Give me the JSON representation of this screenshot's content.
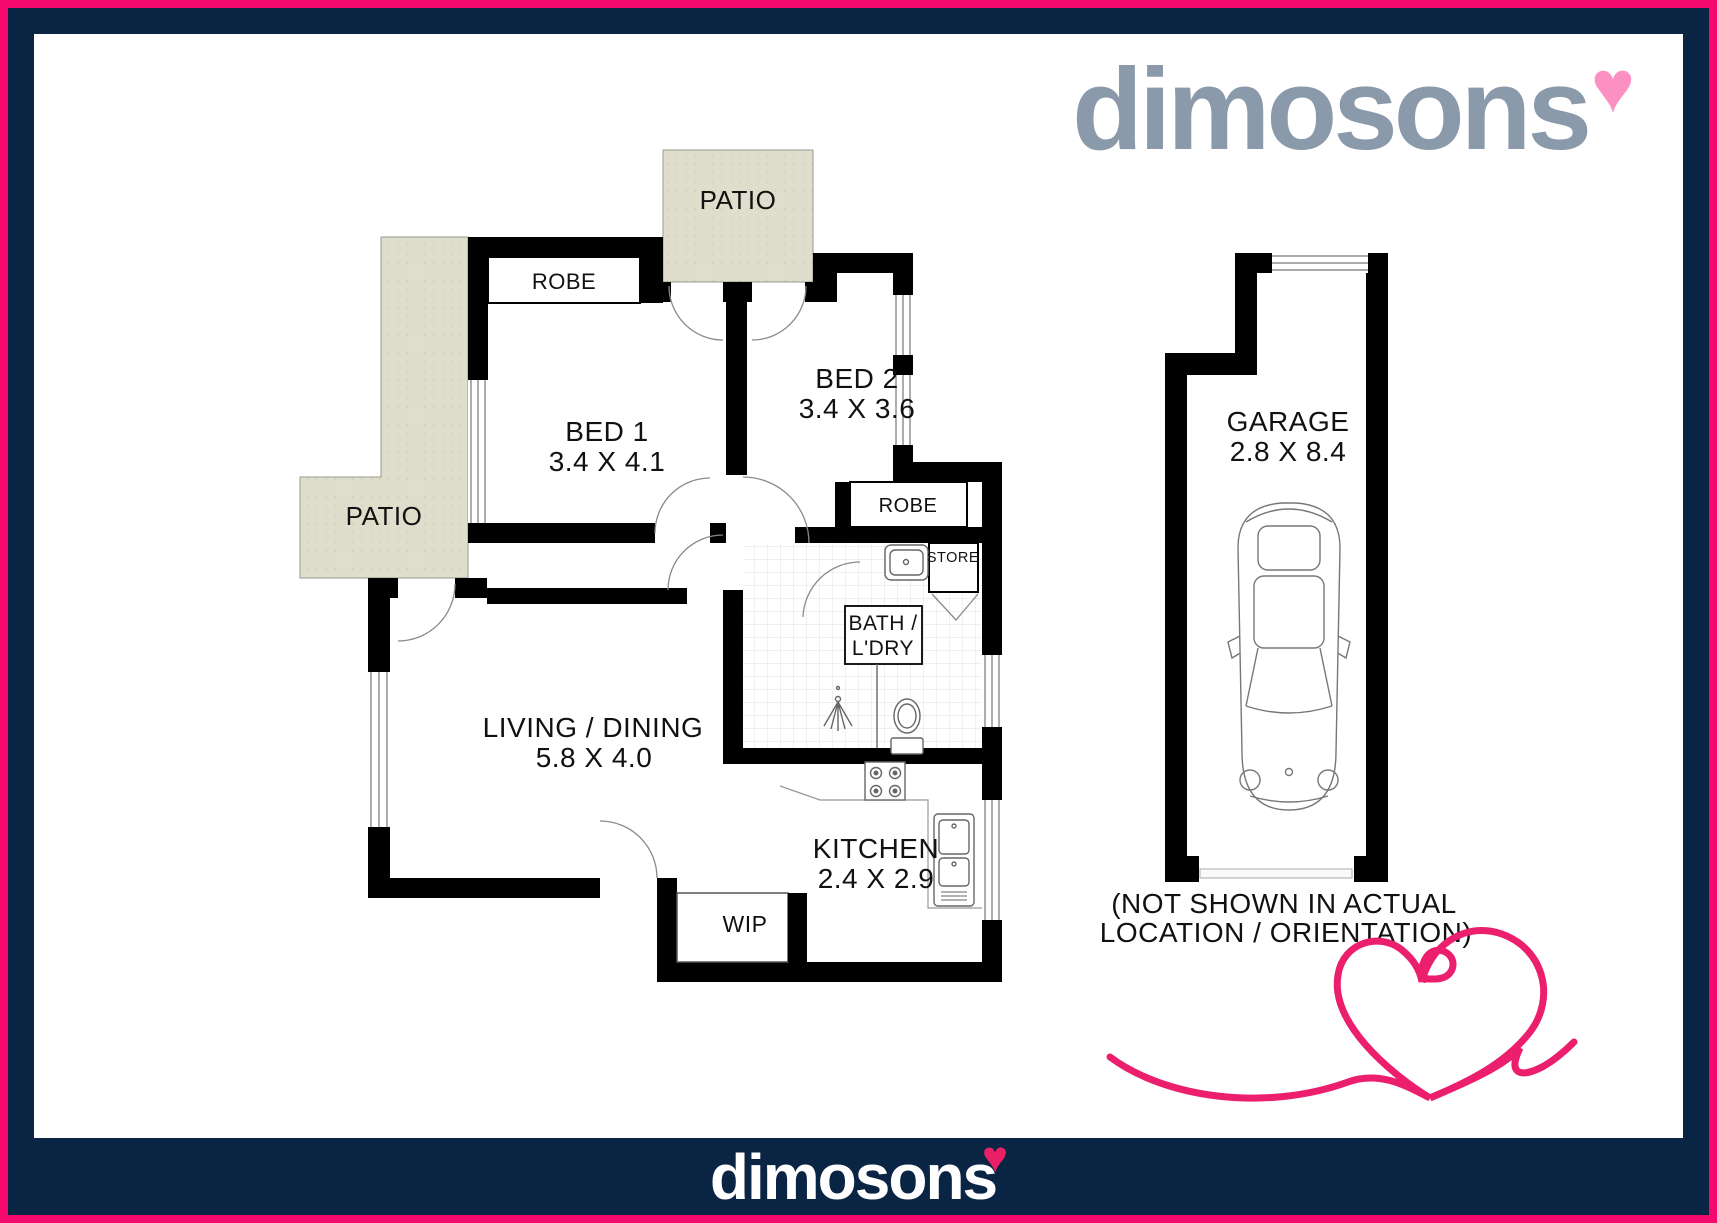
{
  "branding": {
    "logo_text": "dimosons",
    "logo_heart": "♥",
    "logo_color": "#8b9aab",
    "logo_heart_color": "#fc90c2",
    "accent_pink": "#f5096d",
    "navy": "#0a2444",
    "squiggle_pink": "#ec1e6e"
  },
  "floorplan": {
    "rooms": [
      {
        "id": "bed1",
        "name": "BED 1",
        "dims": "3.4 X 4.1"
      },
      {
        "id": "bed2",
        "name": "BED 2",
        "dims": "3.4 X 3.6"
      },
      {
        "id": "living",
        "name": "LIVING / DINING",
        "dims": "5.8 X 4.0"
      },
      {
        "id": "kitchen",
        "name": "KITCHEN",
        "dims": "2.4 X 2.9"
      },
      {
        "id": "garage",
        "name": "GARAGE",
        "dims": "2.8 X 8.4"
      }
    ],
    "labels": {
      "patio_top": "PATIO",
      "patio_left": "PATIO",
      "robe_bed1": "ROBE",
      "robe_bed2": "ROBE",
      "store": "STORE",
      "bath_line1": "BATH /",
      "bath_line2": "L'DRY",
      "wip": "WIP"
    },
    "garage_note": {
      "line1": "(NOT SHOWN IN ACTUAL",
      "line2": "LOCATION / ORIENTATION)"
    }
  },
  "footer": {
    "logo_text": "dimosons",
    "logo_heart": "♥"
  }
}
